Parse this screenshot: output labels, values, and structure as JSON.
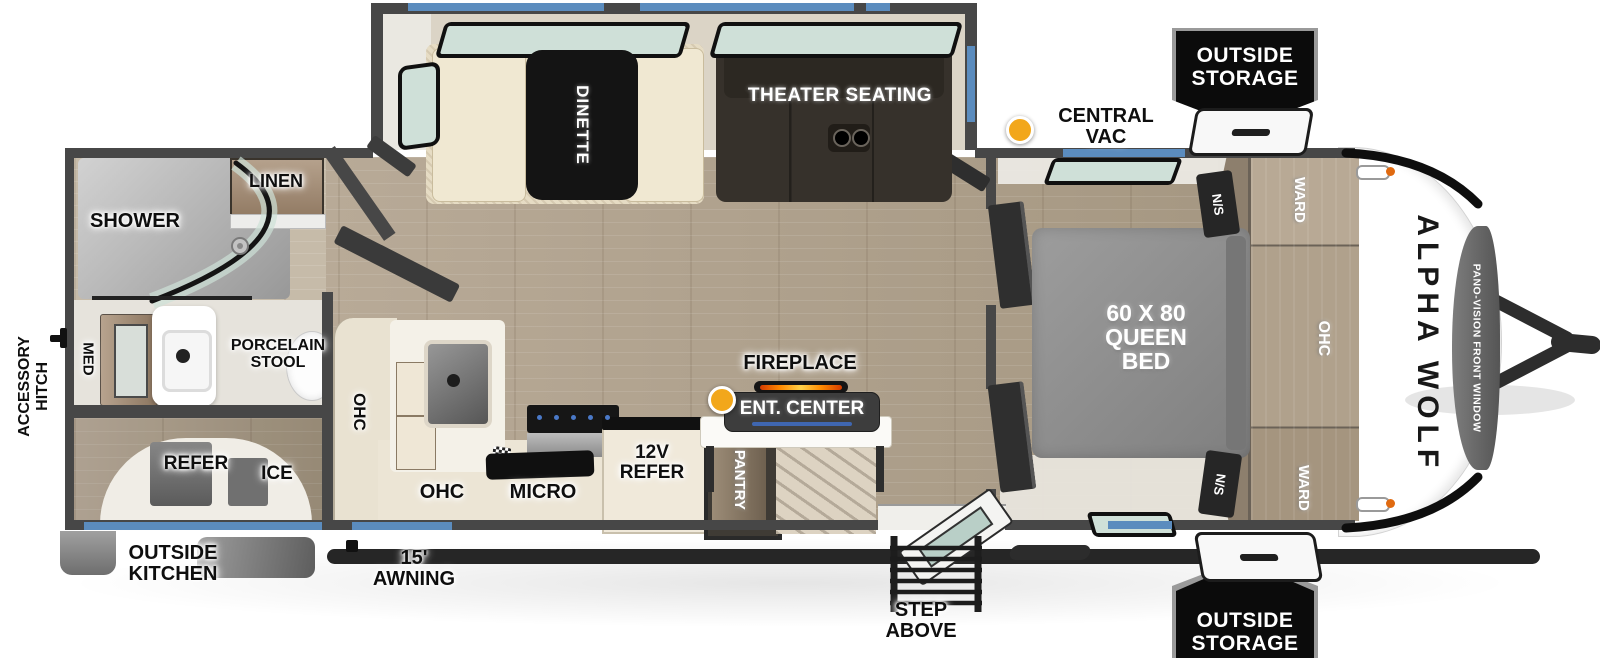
{
  "colors": {
    "wall": "#474747",
    "accent_blue": "#5b8cbe",
    "floor_wood": "#b3a492",
    "counter_beige": "#eae3d3",
    "bed_gray": "#8f8f8f",
    "theater_brown": "#36312b",
    "badge_black": "#0b0b0b",
    "vac_yellow": "#f2a71b",
    "fireplace_flame": "#ff8a00",
    "glass_green": "#cfe0d8"
  },
  "badges": {
    "storage_top": {
      "line1": "OUTSIDE",
      "line2": "STORAGE"
    },
    "storage_bottom": {
      "line1": "OUTSIDE",
      "line2": "STORAGE"
    }
  },
  "callouts": {
    "central_vac": "CENTRAL VAC",
    "step_above": "STEP ABOVE",
    "awning": "15' AWNING",
    "outside_kitchen": {
      "line1": "OUTSIDE",
      "line2": "KITCHEN"
    },
    "accessory_hitch": {
      "line1": "ACCESSORY",
      "line2": "HITCH"
    }
  },
  "rooms": {
    "slide_out": {
      "dinette": "DINETTE",
      "theater_seating": "THEATER SEATING"
    },
    "bathroom": {
      "shower": "SHOWER",
      "linen": "LINEN",
      "med": "MED",
      "porcelain_stool": {
        "line1": "PORCELAIN",
        "line2": "STOOL"
      }
    },
    "outside_kitchen_bay": {
      "refer": "REFER",
      "ice": "ICE"
    },
    "kitchen": {
      "ohc_upper": "OHC",
      "ohc_lower": "OHC",
      "micro": "MICRO",
      "refer_12v": {
        "line1": "12V",
        "line2": "REFER"
      },
      "pantry": "PANTRY"
    },
    "living": {
      "fireplace": "FIREPLACE",
      "ent_center": "ENT. CENTER"
    },
    "bedroom": {
      "bed": {
        "line1": "60 X 80",
        "line2": "QUEEN",
        "line3": "BED"
      },
      "ns_top": "N/S",
      "ns_bottom": "N/S",
      "ward_top": "WARD",
      "ward_bottom": "WARD",
      "ohc": "OHC"
    }
  },
  "front_cap": {
    "brand": "ALPHA WOLF",
    "window": "PANO-VISION FRONT WINDOW"
  }
}
